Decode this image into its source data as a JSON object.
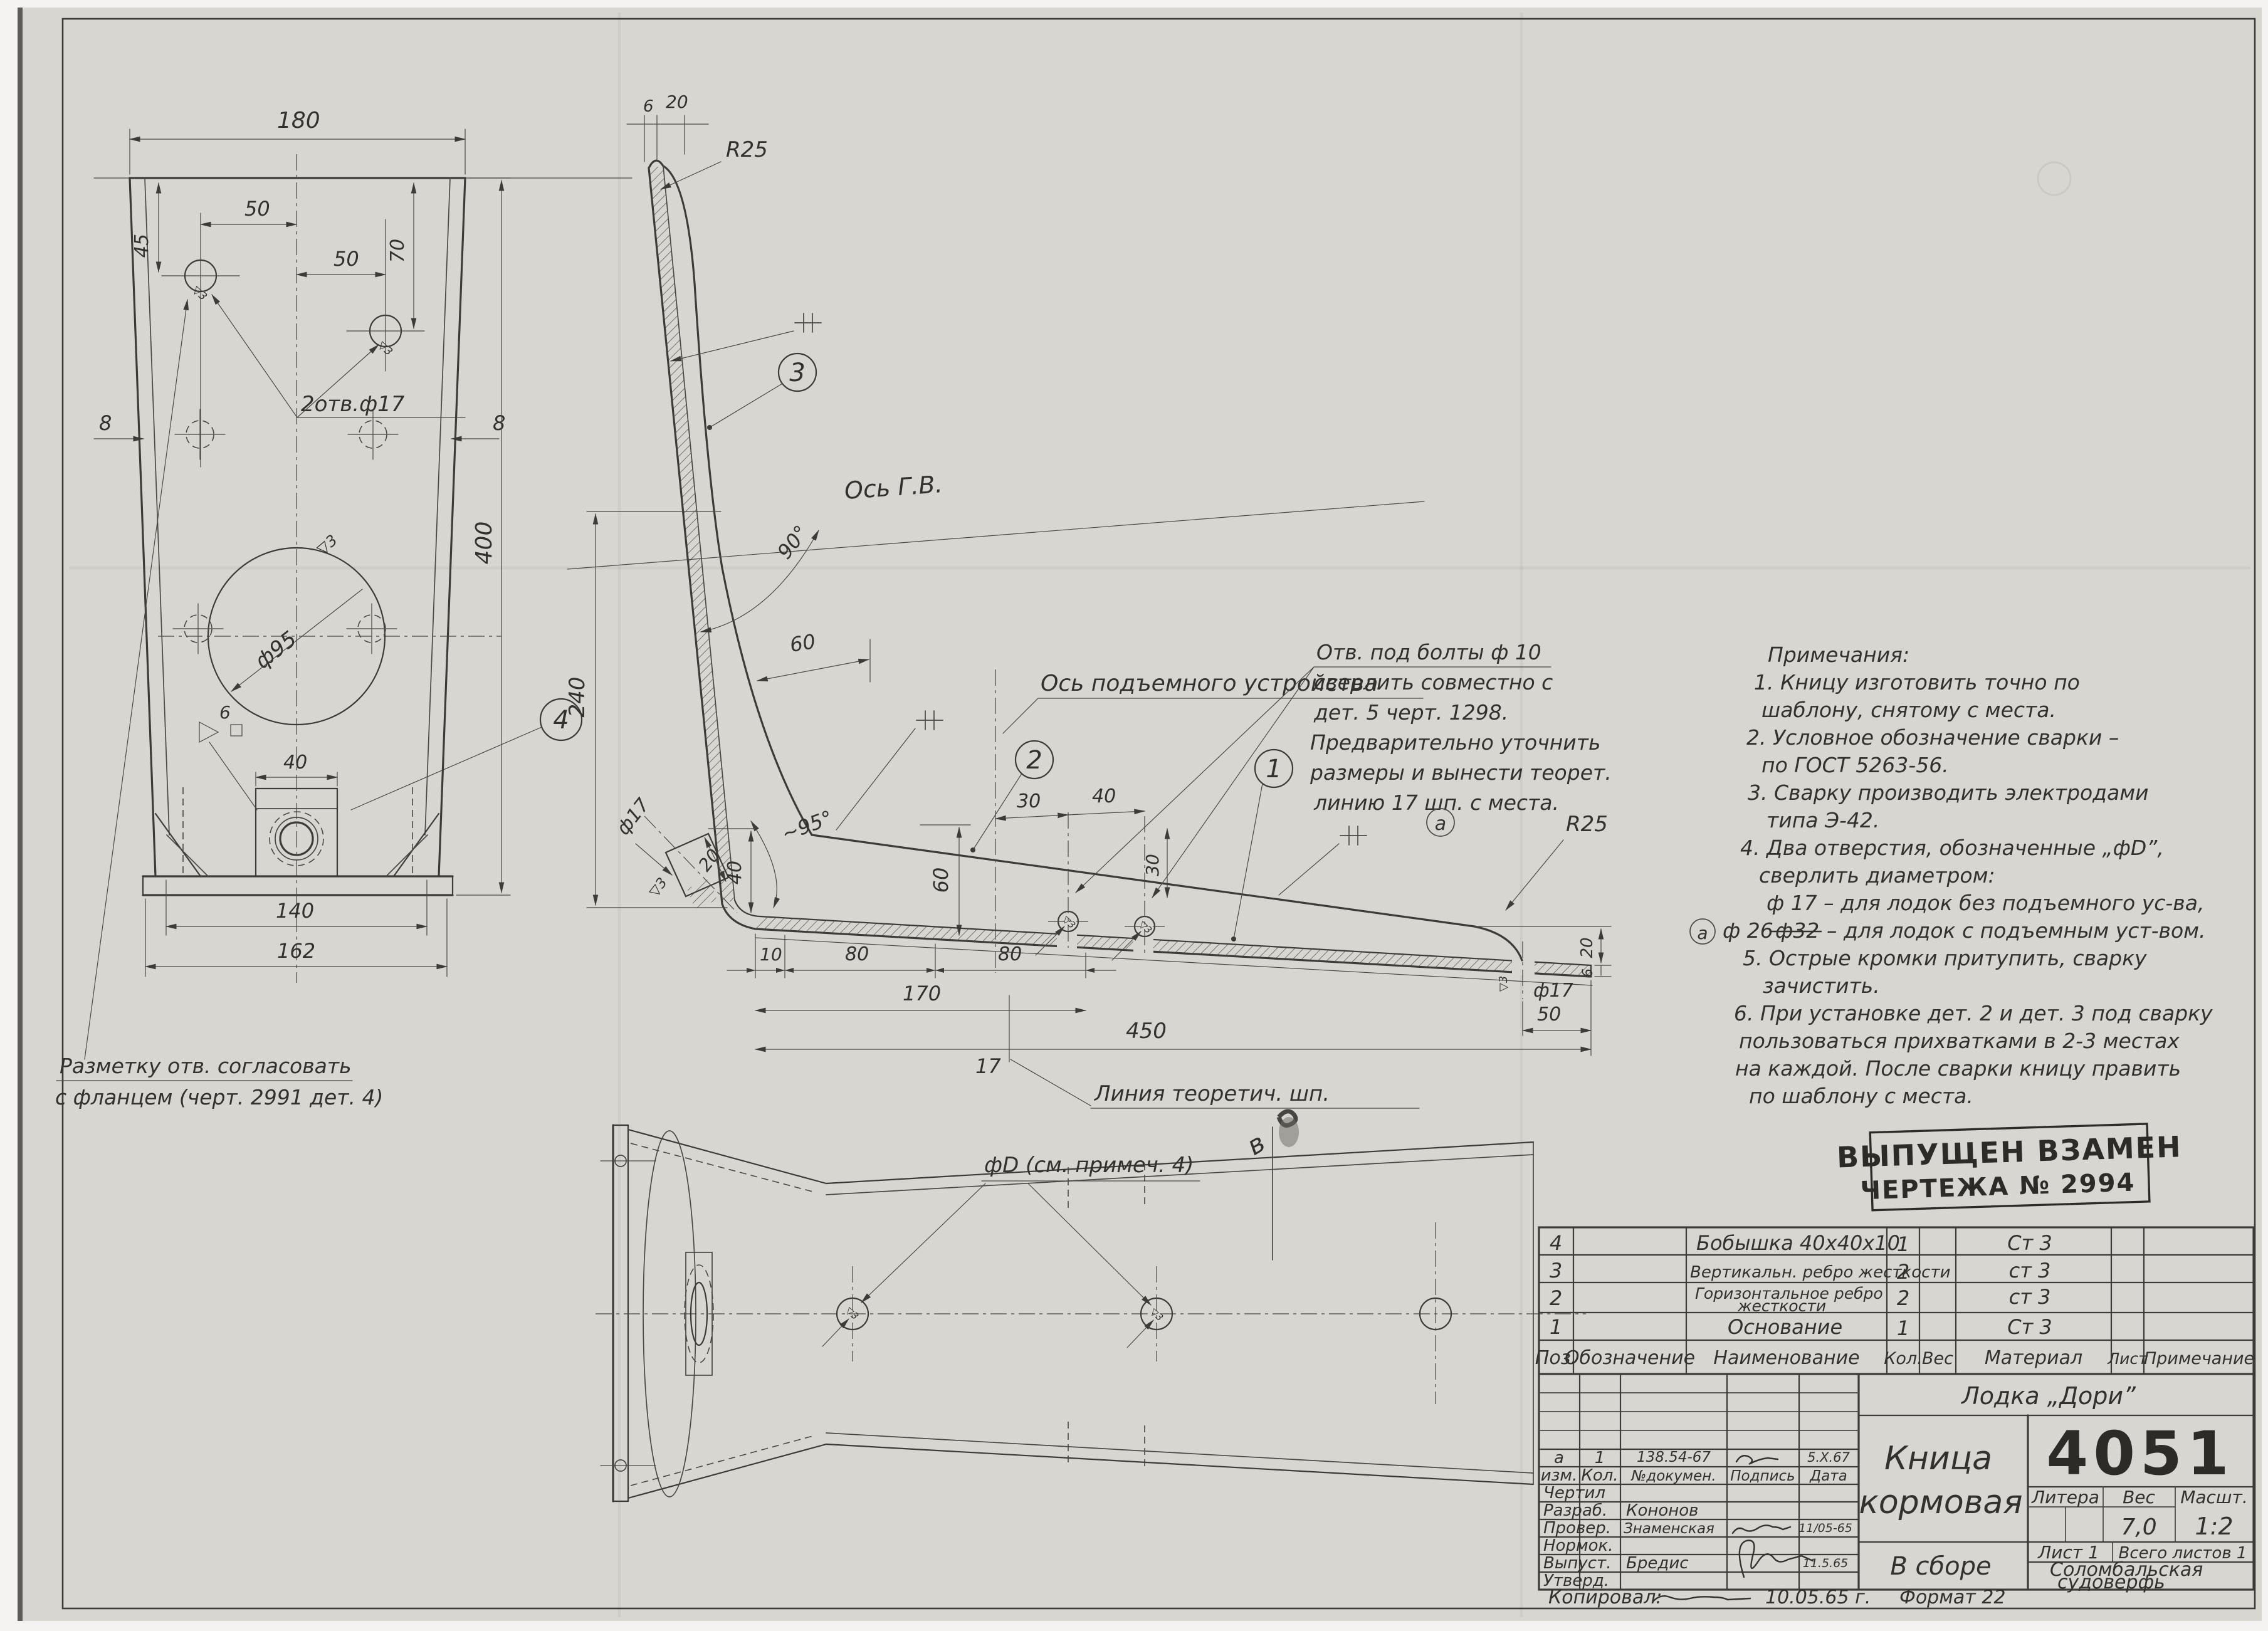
{
  "marks": {
    "finish": "▽3",
    "rev_a": "а"
  },
  "front": {
    "d180": "180",
    "d45": "45",
    "d50a": "50",
    "d50b": "50",
    "d70": "70",
    "d8_left": "8",
    "d8_right": "8",
    "d400": "400",
    "holes_label": "2отв.ф17",
    "dia95": "ф95",
    "d40": "40",
    "d140": "140",
    "d162": "162",
    "weld_size": "6",
    "note_line1": "Разметку отв. согласовать",
    "note_line2": "с фланцем (черт. 2991 дет. 4)"
  },
  "side": {
    "d6_top": "6",
    "d20_top": "20",
    "r25_top": "R25",
    "r25_right": "R25",
    "axis_gv": "Ось Г.В.",
    "axis_lift": "Ось подъемного устройства",
    "a90": "90°",
    "a95": "~95°",
    "d240": "240",
    "d60h": "60",
    "d60v": "60",
    "d40c": "40",
    "d20c": "20",
    "d17c": "ф17",
    "d10": "10",
    "d80a": "80",
    "d80b": "80",
    "d170": "170",
    "d450": "450",
    "d17shp": "17",
    "d30a": "30",
    "d40b": "40",
    "d30v": "30",
    "d20r": "20",
    "d6r": "6",
    "dia17": "ф17",
    "d50r": "50",
    "theor_line": "Линия теоретич. шп.",
    "callout1": "1",
    "callout2": "2",
    "callout3": "3",
    "callout4": "4",
    "bolt_note1": "Отв. под болты ф 10",
    "bolt_note2": "сверлить совместно с",
    "bolt_note3": "дет. 5 черт. 1298.",
    "bolt_note4": "Предварительно уточнить",
    "bolt_note5": "размеры и вынести теорет.",
    "bolt_note6": "линию 17 шп. с места."
  },
  "plan": {
    "label": "фD (см. примеч. 4)",
    "section_mark": "в"
  },
  "notes": {
    "title": "Примечания:",
    "l1": "1. Кницу  изготовить  точно  по",
    "l2": "шаблону, снятому  с  места.",
    "l3": "2. Условное  обозначение  сварки –",
    "l4": "по  ГОСТ  5263-56.",
    "l5": "3. Сварку  производить  электродами",
    "l6": "типа  Э-42.",
    "l7": "4. Два  отверстия, обозначенные  „фD”,",
    "l8": "сверлить  диаметром:",
    "l9": "ф 17 –  для  лодок  без  подъемного  ус-ва,",
    "l10_add": "ф 26",
    "l10_struck": "ф32",
    "l10_rest": "–  для  лодок  с  подъемным  уст-вом.",
    "l11": "5. Острые  кромки  притупить,  сварку",
    "l12": "зачистить.",
    "l13": "6. При установке  дет. 2  и  дет. 3  под  сварку",
    "l14": "пользоваться  прихватками  в 2-3 местах",
    "l15": "на  каждой.  После  сварки  кницу  править",
    "l16": "по  шаблону  с  места."
  },
  "stamp": {
    "line1": "ВЫПУЩЕН ВЗАМЕН",
    "line2": "ЧЕРТЕЖА  № 2994"
  },
  "parts": {
    "headers": {
      "pos": "Поз.",
      "desig": "Обозначение",
      "name": "Наименование",
      "qty": "Кол.",
      "weight": "Вес",
      "material": "Материал",
      "sheet": "Лист",
      "note": "Примечание"
    },
    "rows": [
      {
        "pos": "4",
        "name": "Бобышка 40х40х10",
        "qty": "1",
        "mat": "Ст 3"
      },
      {
        "pos": "3",
        "name": "Вертикальн. ребро жесткости",
        "qty": "2",
        "mat": "ст 3"
      },
      {
        "pos": "2",
        "name1": "Горизонтальное ребро",
        "name2": "жесткости",
        "qty": "2",
        "mat": "ст 3"
      },
      {
        "pos": "1",
        "name": "Основание",
        "qty": "1",
        "mat": "Ст 3"
      }
    ]
  },
  "tb": {
    "project": "Лодка „Дори”",
    "title1": "Кница",
    "title2": "кормовая",
    "assembly": "В сборе",
    "number": "4051",
    "litera": "Литера",
    "ves": "Вес",
    "masht": "Масшт.",
    "ves_val": "7,0",
    "masht_val": "1:2",
    "list": "Лист 1",
    "vsego": "Всего листов 1",
    "org1": "Соломбальская",
    "org2": "судоверфь",
    "rev": {
      "izm": "а",
      "kol": "1",
      "doc": "138.54-67",
      "date": "5.X.67"
    },
    "cols": {
      "izm": "изм.",
      "kol": "Кол.",
      "doc": "№докумен.",
      "sign": "Подпись",
      "date": "Дата"
    },
    "rows": {
      "chertil": "Чертил",
      "razrab": "Разраб.",
      "razrab_name": "Кононов",
      "prover": "Провер.",
      "prover_name": "Знаменская",
      "prover_date": "11/05-65",
      "normok": "Нормок.",
      "vypust": "Выпуст.",
      "vypust_name": "Бредис",
      "vypust_date": "11.5.65",
      "utverd": "Утверд."
    },
    "kopir": "Копировал:",
    "kopir_date": "10.05.65 г.",
    "format": "Формат 22"
  }
}
